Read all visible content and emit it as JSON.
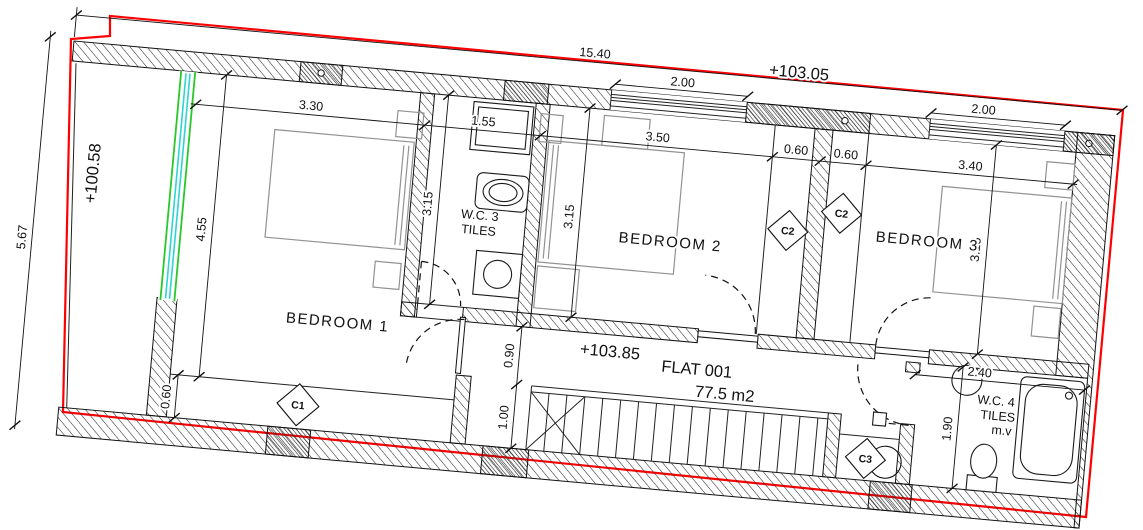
{
  "plan": {
    "levels": {
      "site_left": "+100.58",
      "top": "+103.05",
      "hall": "+103.85"
    },
    "flat": {
      "label": "FLAT 001",
      "area": "77.5 m2"
    },
    "rooms": {
      "bedroom1": "BEDROOM 1",
      "bedroom2": "BEDROOM  2",
      "bedroom3": "BEDROOM 3"
    },
    "wc3": {
      "line1": "W.C. 3",
      "line2": "TILES"
    },
    "wc4": {
      "line1": "W.C. 4",
      "line2": "TILES",
      "line3": "m.v"
    },
    "markers": {
      "c1": "C1",
      "c2a": "C2",
      "c2b": "C2",
      "c3": "C3"
    },
    "dims": {
      "total_w": "15.40",
      "total_h": "5.67",
      "b1_w": "3.30",
      "b1_h": "4.55",
      "wc3_w": "1.55",
      "wc3_h": "3.15",
      "b2_w": "3.50",
      "b2_h": "3.15",
      "closet_a": "0.60",
      "closet_b": "0.60",
      "b3_w": "3.40",
      "b3_h": "3.15",
      "win2": "2.00",
      "win3": "2.00",
      "hall": "0.90",
      "stair": "1.00",
      "b1_strip": "0.60",
      "wc4_w": "2.40",
      "wc4_h": "1.90"
    },
    "colors": {
      "boundary_red": "#fe0000",
      "glazing_green": "#28c828",
      "glazing_cyan": "#2fd3d3",
      "furniture_gray": "#929292",
      "line_black": "#111111"
    }
  }
}
